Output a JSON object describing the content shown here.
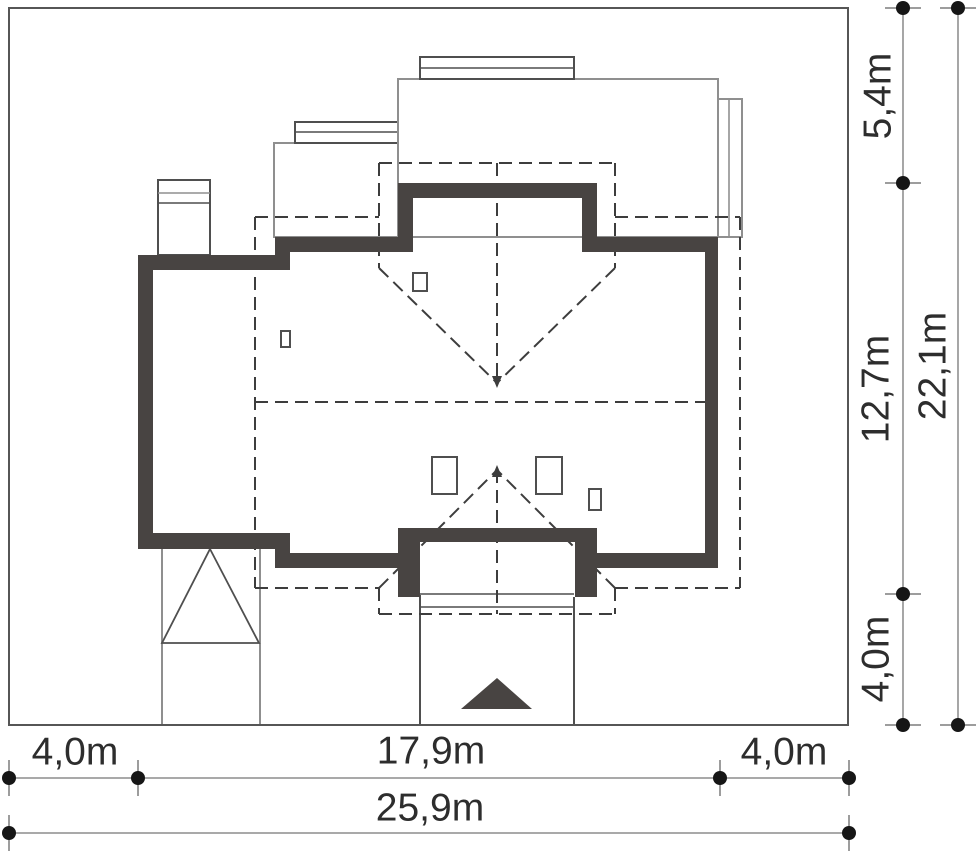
{
  "drawing": {
    "type": "house-site-plan",
    "dimensions_right": [
      {
        "id": "right-top",
        "label": "5,4m"
      },
      {
        "id": "right-middle",
        "label": "12,7m"
      },
      {
        "id": "right-bottom",
        "label": "4,0m"
      },
      {
        "id": "right-total",
        "label": "22,1m"
      }
    ],
    "dimensions_bottom": [
      {
        "id": "bottom-left",
        "label": "4,0m"
      },
      {
        "id": "bottom-center",
        "label": "17,9m"
      },
      {
        "id": "bottom-right",
        "label": "4,0m"
      },
      {
        "id": "bottom-total",
        "label": "25,9m"
      }
    ],
    "colors": {
      "background": "#ffffff",
      "wall": "#484442",
      "dashed_roof": "#3d3d3d",
      "plot_border": "#565656",
      "thin_gray": "#8f8f8f",
      "thin_dark": "#4f4f4f",
      "dim_line": "#9d9d9d",
      "dim_dot": "#161616",
      "text": "#2d2d2d"
    }
  }
}
